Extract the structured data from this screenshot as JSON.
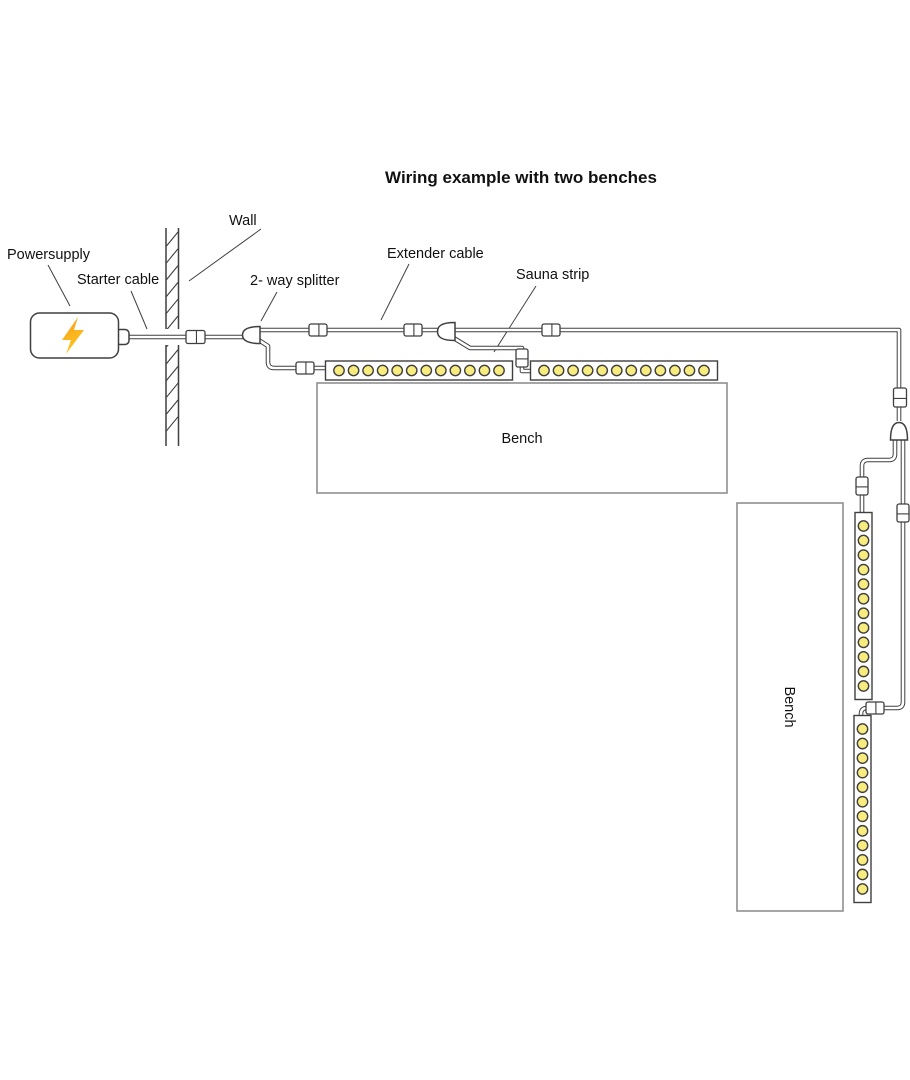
{
  "title": "Wiring example with two benches",
  "labels": {
    "powersupply": "Powersupply",
    "starter_cable": "Starter cable",
    "wall": "Wall",
    "two_way_splitter": "2- way splitter",
    "extender_cable": "Extender cable",
    "sauna_strip": "Sauna strip",
    "bench_top": "Bench",
    "bench_right": "Bench"
  },
  "components": {
    "power_supply": {
      "icon": "lightning-bolt-icon"
    },
    "sauna_strips": [
      {
        "id": "strip_h1",
        "led_count": 12
      },
      {
        "id": "strip_h2",
        "led_count": 12
      },
      {
        "id": "strip_v1",
        "led_count": 12
      },
      {
        "id": "strip_v2",
        "led_count": 12
      }
    ],
    "splitter_count": 3,
    "connector_count": 10,
    "bench_count": 2
  },
  "colors": {
    "line": "#3f3f3f",
    "bench_outline": "#8f8f8f",
    "led_fill": "#f7ec7d",
    "bolt_orange": "#f59c1d",
    "bolt_yellow": "#ffc61e",
    "text": "#111111",
    "background": "#ffffff"
  }
}
